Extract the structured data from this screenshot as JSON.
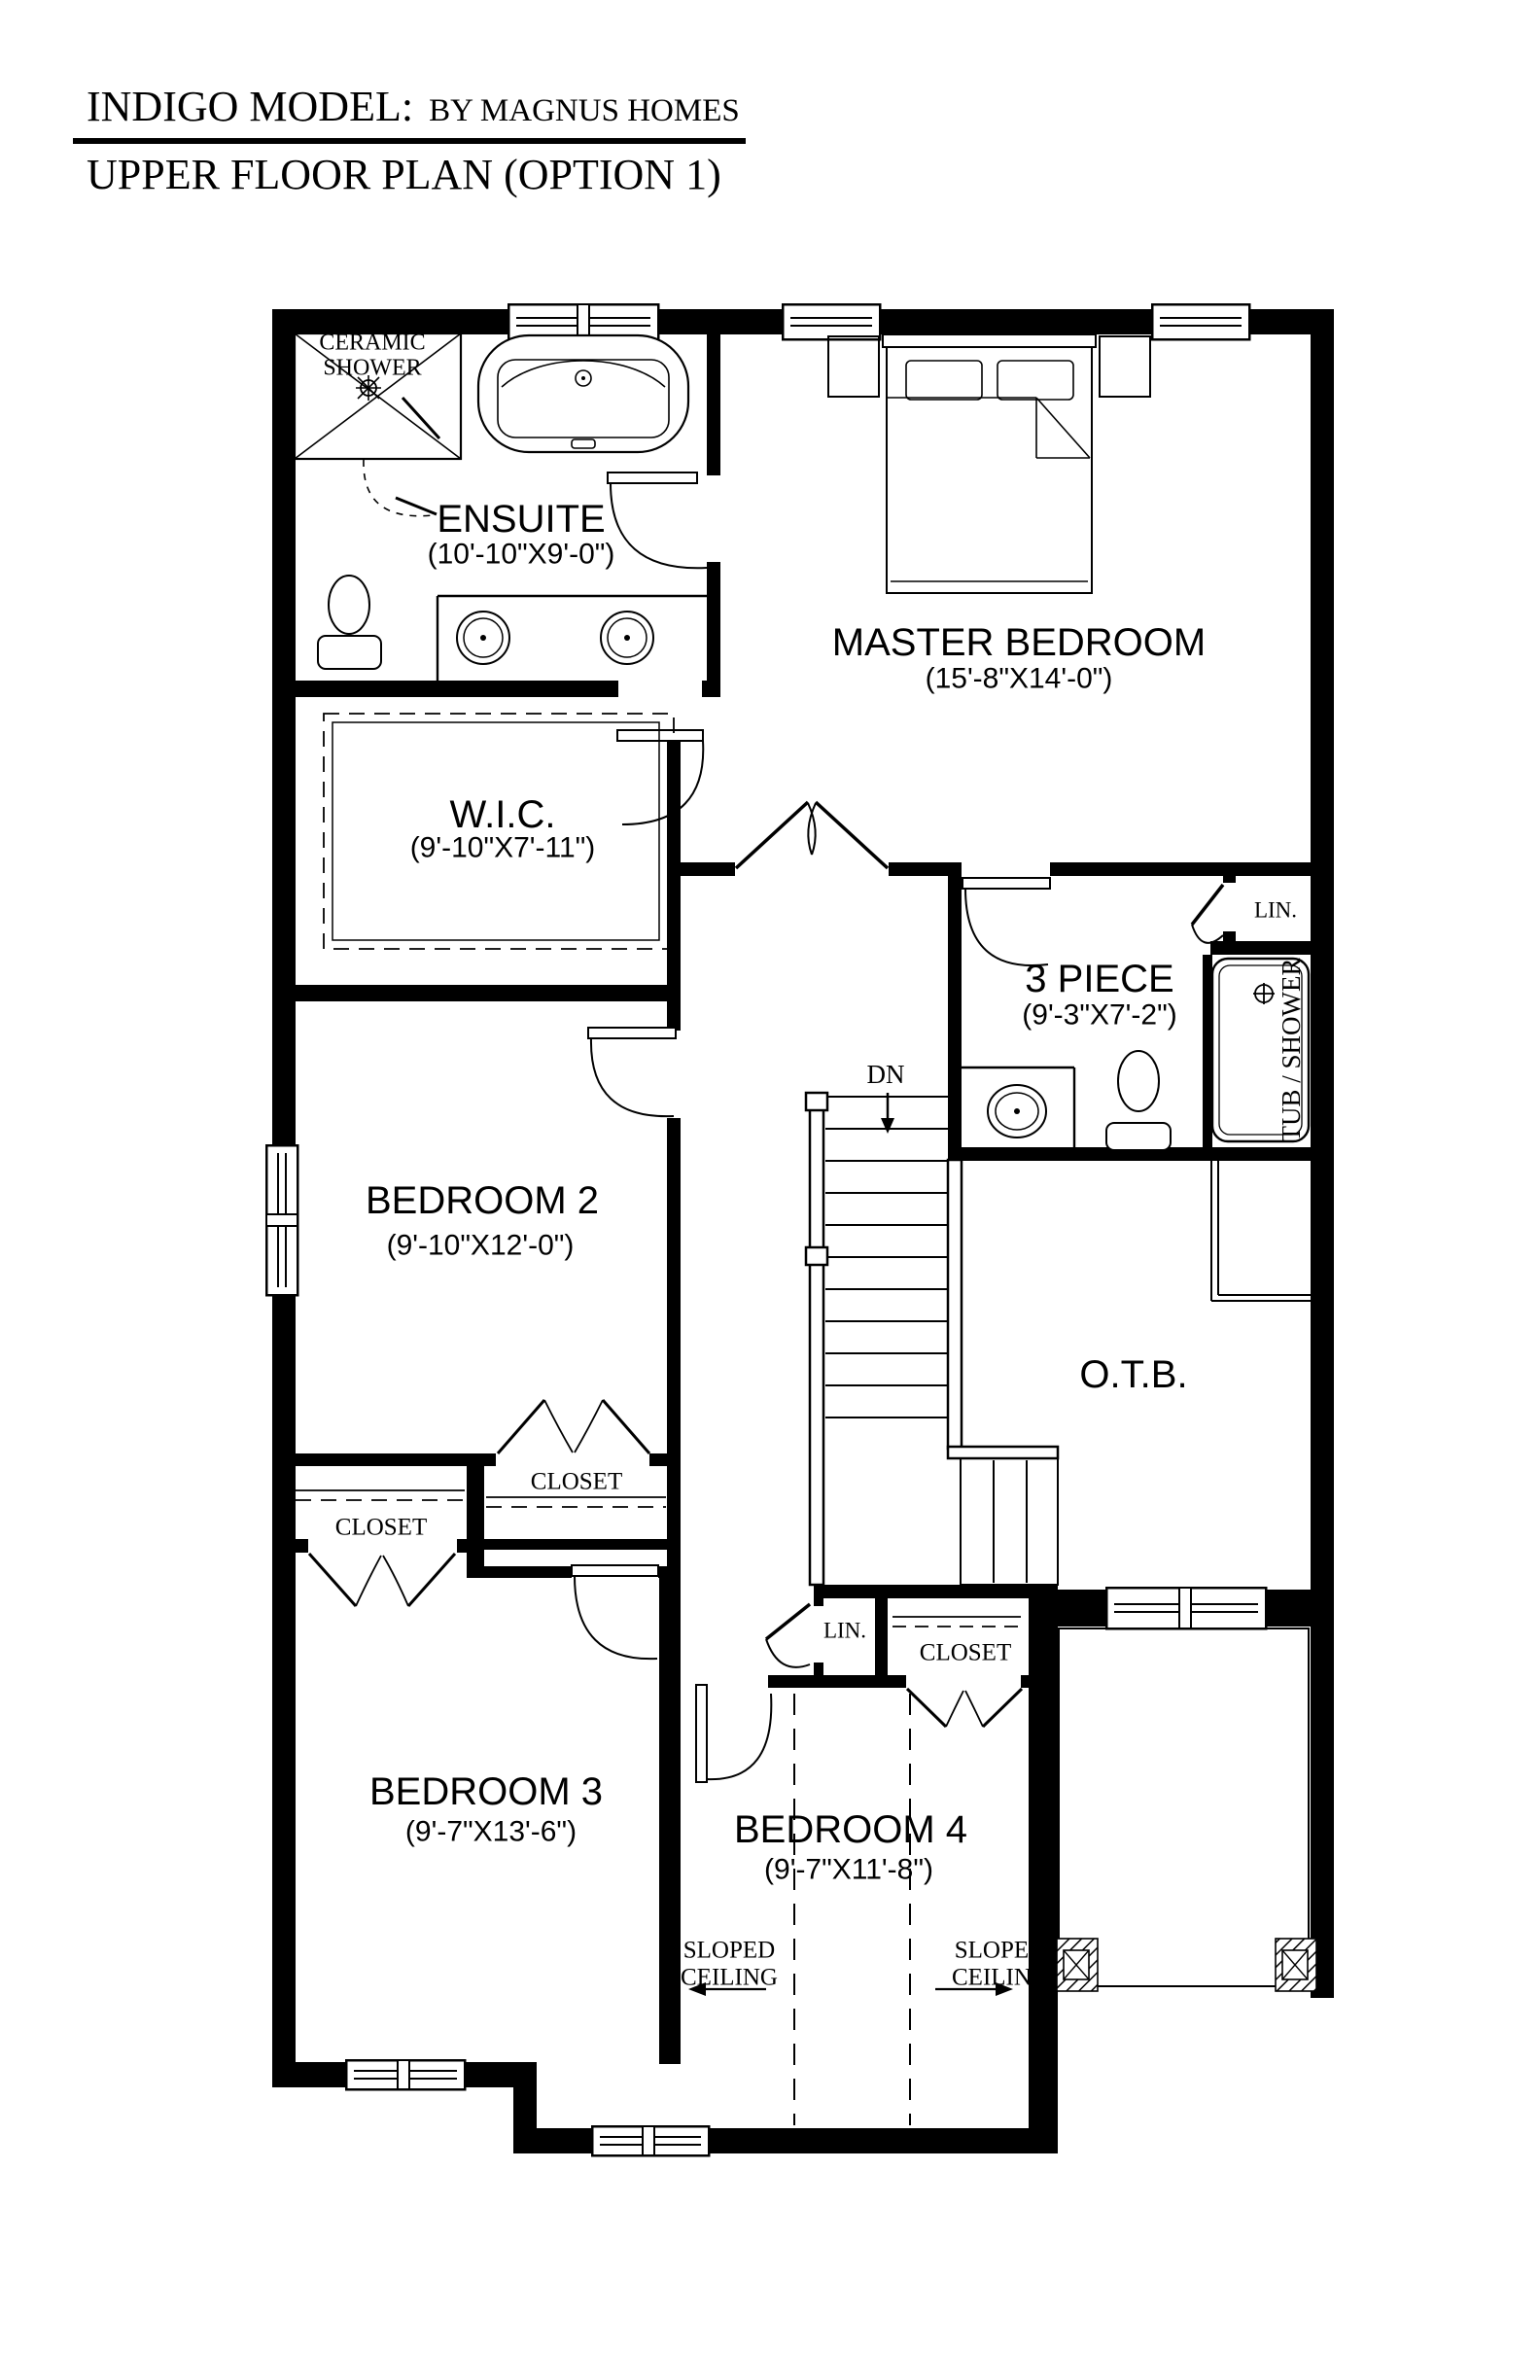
{
  "title": {
    "model": "INDIGO MODEL:",
    "builder": "BY MAGNUS HOMES",
    "subtitle": "UPPER FLOOR PLAN (OPTION 1)"
  },
  "rooms": {
    "ensuite": {
      "name": "ENSUITE",
      "dims": "(10'-10\"X9'-0\")"
    },
    "master_bedroom": {
      "name": "MASTER BEDROOM",
      "dims": "(15'-8\"X14'-0\")"
    },
    "wic": {
      "name": "W.I.C.",
      "dims": "(9'-10\"X7'-11\")"
    },
    "three_piece": {
      "name": "3 PIECE",
      "dims": "(9'-3\"X7'-2\")"
    },
    "bedroom_2": {
      "name": "BEDROOM 2",
      "dims": "(9'-10\"X12'-0\")"
    },
    "bedroom_3": {
      "name": "BEDROOM 3",
      "dims": "(9'-7\"X13'-6\")"
    },
    "bedroom_4": {
      "name": "BEDROOM 4",
      "dims": "(9'-7\"X11'-8\")"
    },
    "open_to_below": {
      "name": "O.T.B."
    }
  },
  "labels": {
    "ceramic_shower_line1": "CERAMIC",
    "ceramic_shower_line2": "SHOWER",
    "linen_bath": "LIN.",
    "linen_hall": "LIN.",
    "tub_shower": "TUB / SHOWER",
    "closet_bedroom2": "CLOSET",
    "closet_bedroom3": "CLOSET",
    "closet_bedroom4": "CLOSET",
    "stairs_down": "DN",
    "sloped_left_line1": "SLOPED",
    "sloped_left_line2": "CEILING",
    "sloped_right_line1": "SLOPED",
    "sloped_right_line2": "CEILING"
  },
  "colors": {
    "ink": "#000000",
    "paper": "#ffffff"
  }
}
